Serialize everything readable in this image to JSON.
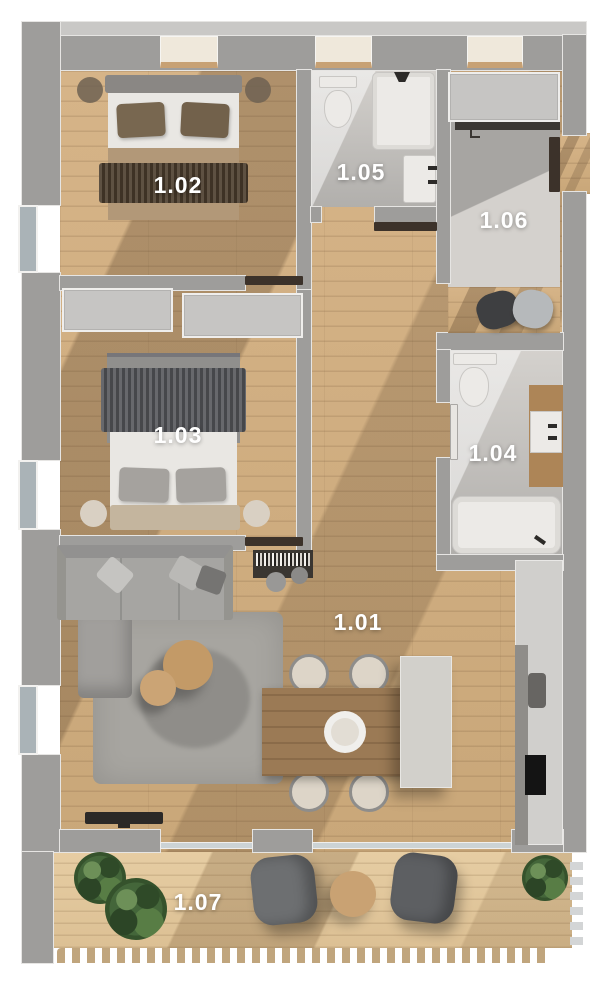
{
  "floor_plan": {
    "rooms": [
      {
        "id": "room-1-01",
        "label": "1.01"
      },
      {
        "id": "room-1-02",
        "label": "1.02"
      },
      {
        "id": "room-1-03",
        "label": "1.03"
      },
      {
        "id": "room-1-04",
        "label": "1.04"
      },
      {
        "id": "room-1-05",
        "label": "1.05"
      },
      {
        "id": "room-1-06",
        "label": "1.06"
      },
      {
        "id": "room-1-07",
        "label": "1.07"
      }
    ],
    "colors": {
      "wall": "#9e9d9b",
      "wall-light": "#c9c8c6",
      "wall-outline": "#e6e5e3",
      "wood": "#c9a779",
      "wood-light": "#d6b488",
      "tile": "#b1afac",
      "tile-light": "#d4d1cd",
      "concrete": "#a7a5a2",
      "white-fixture": "#eceae7",
      "window-glass": "#aab3b7",
      "terrace-wood": "#dcc094",
      "terrace-light": "#e6cda3",
      "door-dark": "#3c322a",
      "label-white": "#ffffff"
    }
  }
}
